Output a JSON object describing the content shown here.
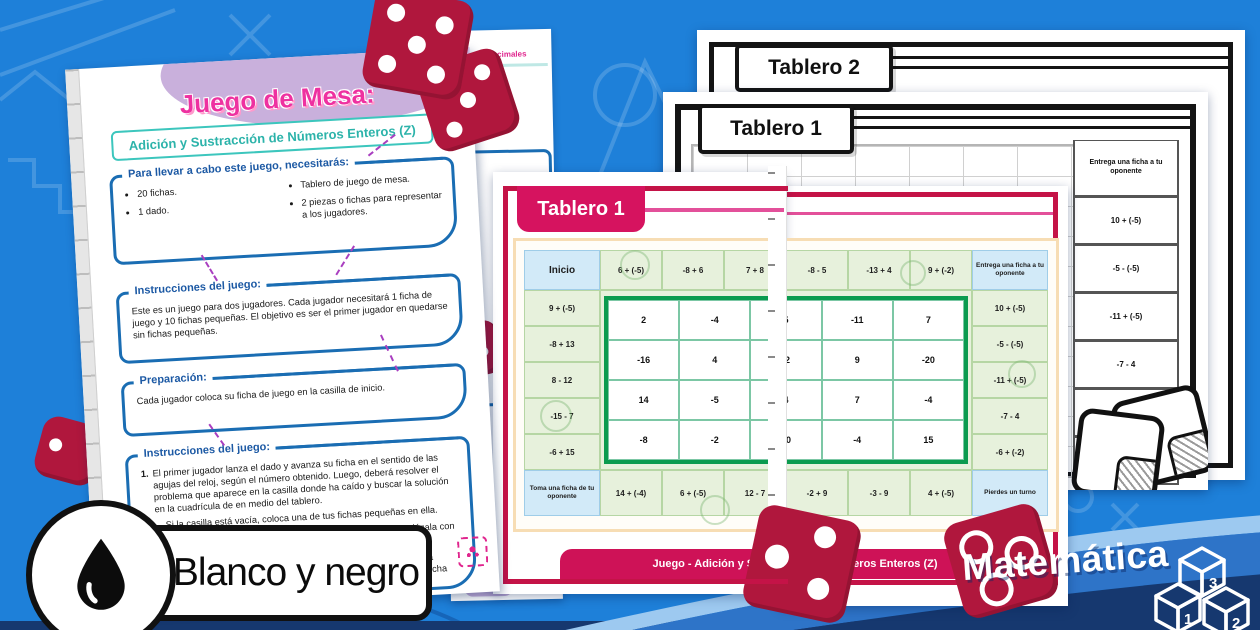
{
  "badge": {
    "label": "Blanco y negro"
  },
  "ribbon": {
    "label": "Matemática",
    "cube_digits": [
      "1",
      "2",
      "3"
    ]
  },
  "sheet_behind": {
    "partial_title": "s y Decimales"
  },
  "instruction_sheet": {
    "title": "Juego de Mesa:",
    "subtitle": "Adición y Sustracción de Números Enteros (Z)",
    "materials": {
      "header": "Para llevar a cabo este juego, necesitarás:",
      "col1": [
        "20 fichas.",
        "1 dado."
      ],
      "col2": [
        "Tablero de juego de mesa.",
        "2 piezas o fichas para representar a los jugadores."
      ]
    },
    "instructions": {
      "header": "Instrucciones del juego:",
      "body": "Este es un juego para dos jugadores. Cada jugador necesitará 1 ficha de juego y 10 fichas pequeñas. El objetivo es ser el primer jugador en quedarse sin fichas pequeñas."
    },
    "preparation": {
      "header": "Preparación:",
      "body": "Cada jugador coloca su ficha de juego en la casilla de inicio."
    },
    "gameplay": {
      "header": "Instrucciones del juego:",
      "step1": "El primer jugador lanza el dado y avanza su ficha en el sentido de las agujas del reloj, según el número obtenido. Luego, deberá resolver el problema que aparece en la casilla donde ha caído y buscar la solución en la cuadrícula de en medio del tablero.",
      "bullets": [
        "Si la casilla está vacía, coloca una de tus fichas pequeñas en ella.",
        "Si la casilla tiene una ficha del otro jugador, retírala y reemplázala con una de tus fichas.",
        "Si la casilla ya tiene una de tus fichas, coloca una segunda ficha encima. Esto bloqueará la casilla, lo que significa que ninguna ficha podrá ser retirada de ahí.",
        "Si la casilla ya está bloqueada por el otro jugador, no podrás colocar ninguna ficha en ella."
      ]
    }
  },
  "bw_sheets": {
    "tablero2_label": "Tablero 2",
    "tablero1_label": "Tablero 1",
    "right_column": [
      "Entrega una ficha a tu oponente",
      "10 + (-5)",
      "-5 - (-5)",
      "-11 + (-5)",
      "-7 - 4",
      "-6 + (-2)",
      "Pierdes un turno"
    ]
  },
  "color_board": {
    "header_label": "Tablero 1",
    "footer_label": "Juego - Adición y Sustracción de Números Enteros (Z)",
    "top_row": [
      "Inicio",
      "6 + (-5)",
      "-8 + 6",
      "7 + 8",
      "-8 - 5",
      "-13 + 4",
      "9 + (-2)",
      "Entrega una ficha a tu oponente"
    ],
    "left_col": [
      "9 + (-5)",
      "-8 + 13",
      "8 - 12",
      "-15 - 7",
      "-6 + 15"
    ],
    "right_col": [
      "10 + (-5)",
      "-5 - (-5)",
      "-11 + (-5)",
      "-7 - 4",
      "-6 + (-2)"
    ],
    "bottom_row": [
      "Toma una ficha de tu oponente",
      "14 + (-4)",
      "6 + (-5)",
      "12 - 7",
      "-2 + 9",
      "-3 - 9",
      "4 + (-5)",
      "Pierdes un turno"
    ],
    "grid": [
      [
        "2",
        "-4",
        "5",
        "-11",
        "7"
      ],
      [
        "-16",
        "4",
        "-2",
        "9",
        "-20"
      ],
      [
        "14",
        "-5",
        "4",
        "7",
        "-4"
      ],
      [
        "-8",
        "-2",
        "20",
        "-4",
        "15"
      ]
    ]
  },
  "colors": {
    "background": "#1e80d9",
    "navy": "#16386f",
    "crimson_frame": "#c41347",
    "pink_tab": "#d6135f",
    "title_pink": "#ee31a0",
    "teal": "#2cb3aa",
    "box_blue": "#1a6db3",
    "green_cell": "#e7f1dc",
    "blue_cell": "#d2eaf8",
    "solution_green": "#0b9b4f",
    "lavender": "#c9b0dc"
  }
}
